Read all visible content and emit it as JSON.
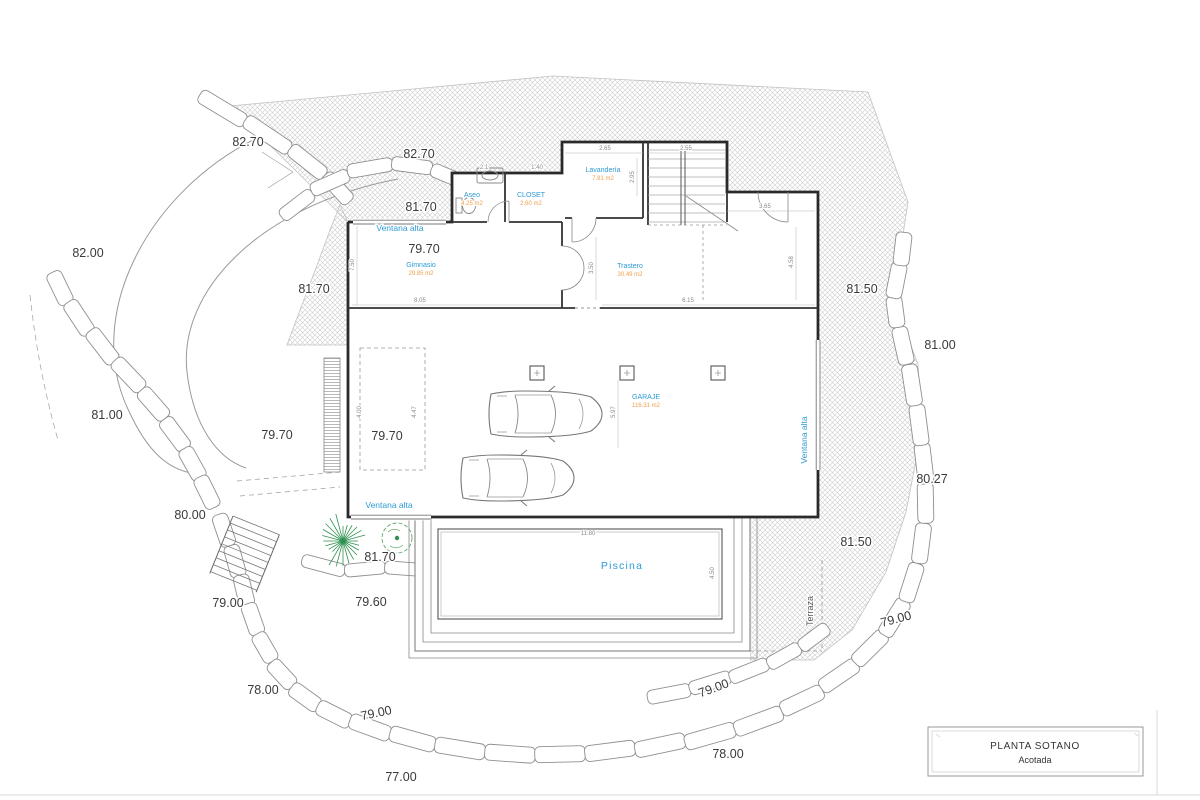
{
  "title_block": {
    "line1": "PLANTA SOTANO",
    "line2": "Acotada"
  },
  "colors": {
    "accent_blue": "#2e9bd6",
    "accent_orange": "#f09f4d",
    "wall": "#2a2a2a",
    "hatch": "#cdcdcd",
    "stone": "#8f8f8f",
    "green": "#2f9050"
  },
  "rooms": [
    {
      "name": "Aseo",
      "area": "4.25 m2",
      "x": 472,
      "y": 197
    },
    {
      "name": "CLOSET",
      "area": "2.60 m2",
      "x": 531,
      "y": 197
    },
    {
      "name": "Lavandería",
      "area": "7.81 m2",
      "x": 603,
      "y": 172
    },
    {
      "name": "Gimnasio",
      "area": "29.85 m2",
      "x": 421,
      "y": 267
    },
    {
      "name": "Trastero",
      "area": "30.49 m2",
      "x": 630,
      "y": 268
    },
    {
      "name": "GARAJE",
      "area": "116.31 m2",
      "x": 646,
      "y": 399
    }
  ],
  "pool": {
    "label": "Piscina",
    "x": 622,
    "y": 569
  },
  "terrace": {
    "label": "Terraza",
    "x": 813,
    "y": 611,
    "r": -90
  },
  "window_labels": [
    {
      "t": "Ventana alta",
      "x": 400,
      "y": 231,
      "r": 0
    },
    {
      "t": "Ventana alta",
      "x": 389,
      "y": 508,
      "r": 0
    },
    {
      "t": "Ventana alta",
      "x": 807,
      "y": 440,
      "r": -90
    }
  ],
  "elevation_labels": [
    {
      "t": "82.70",
      "x": 248,
      "y": 146,
      "r": 0
    },
    {
      "t": "82.70",
      "x": 419,
      "y": 158,
      "r": 0
    },
    {
      "t": "81.70",
      "x": 421,
      "y": 211,
      "r": 0
    },
    {
      "t": "82.00",
      "x": 88,
      "y": 257,
      "r": 0
    },
    {
      "t": "79.70",
      "x": 424,
      "y": 253,
      "r": 0
    },
    {
      "t": "81.70",
      "x": 314,
      "y": 293,
      "r": 0
    },
    {
      "t": "81.50",
      "x": 862,
      "y": 293,
      "r": 0
    },
    {
      "t": "81.00",
      "x": 940,
      "y": 349,
      "r": 0
    },
    {
      "t": "81.00",
      "x": 107,
      "y": 419,
      "r": 0
    },
    {
      "t": "79.70",
      "x": 277,
      "y": 439,
      "r": 0
    },
    {
      "t": "79.70",
      "x": 387,
      "y": 440,
      "r": 0
    },
    {
      "t": "80.27",
      "x": 932,
      "y": 483,
      "r": 0
    },
    {
      "t": "80.00",
      "x": 190,
      "y": 519,
      "r": 0
    },
    {
      "t": "81.50",
      "x": 856,
      "y": 546,
      "r": 0
    },
    {
      "t": "81.70",
      "x": 380,
      "y": 561,
      "r": 0
    },
    {
      "t": "79.00",
      "x": 228,
      "y": 607,
      "r": 0
    },
    {
      "t": "79.60",
      "x": 371,
      "y": 606,
      "r": 0
    },
    {
      "t": "79.00",
      "x": 897,
      "y": 623,
      "r": -15
    },
    {
      "t": "78.00",
      "x": 263,
      "y": 694,
      "r": 0
    },
    {
      "t": "79.00",
      "x": 715,
      "y": 692,
      "r": -20
    },
    {
      "t": "79.00",
      "x": 377,
      "y": 717,
      "r": -12
    },
    {
      "t": "78.00",
      "x": 728,
      "y": 758,
      "r": 0
    },
    {
      "t": "77.00",
      "x": 401,
      "y": 781,
      "r": 0
    }
  ],
  "dimensions": [
    {
      "t": "2.1",
      "x": 484,
      "y": 169,
      "r": 0
    },
    {
      "t": "1.40",
      "x": 537,
      "y": 169,
      "r": 0
    },
    {
      "t": "2.65",
      "x": 605,
      "y": 150,
      "r": 0
    },
    {
      "t": "2.55",
      "x": 686,
      "y": 150,
      "r": 0
    },
    {
      "t": "2.95",
      "x": 634,
      "y": 177,
      "r": -90
    },
    {
      "t": "3.65",
      "x": 765,
      "y": 208,
      "r": 0
    },
    {
      "t": "7.50",
      "x": 354,
      "y": 265,
      "r": -90
    },
    {
      "t": "3.50",
      "x": 593,
      "y": 268,
      "r": -90
    },
    {
      "t": "4.58",
      "x": 793,
      "y": 262,
      "r": -90
    },
    {
      "t": "8.05",
      "x": 420,
      "y": 302,
      "r": 0
    },
    {
      "t": "6.15",
      "x": 688,
      "y": 302,
      "r": 0
    },
    {
      "t": "4.00",
      "x": 361,
      "y": 412,
      "r": -90
    },
    {
      "t": "4.47",
      "x": 416,
      "y": 412,
      "r": -90
    },
    {
      "t": "5.97",
      "x": 615,
      "y": 412,
      "r": -90
    },
    {
      "t": "11.80",
      "x": 588,
      "y": 535,
      "r": 0
    },
    {
      "t": "4.50",
      "x": 714,
      "y": 573,
      "r": -90
    }
  ]
}
